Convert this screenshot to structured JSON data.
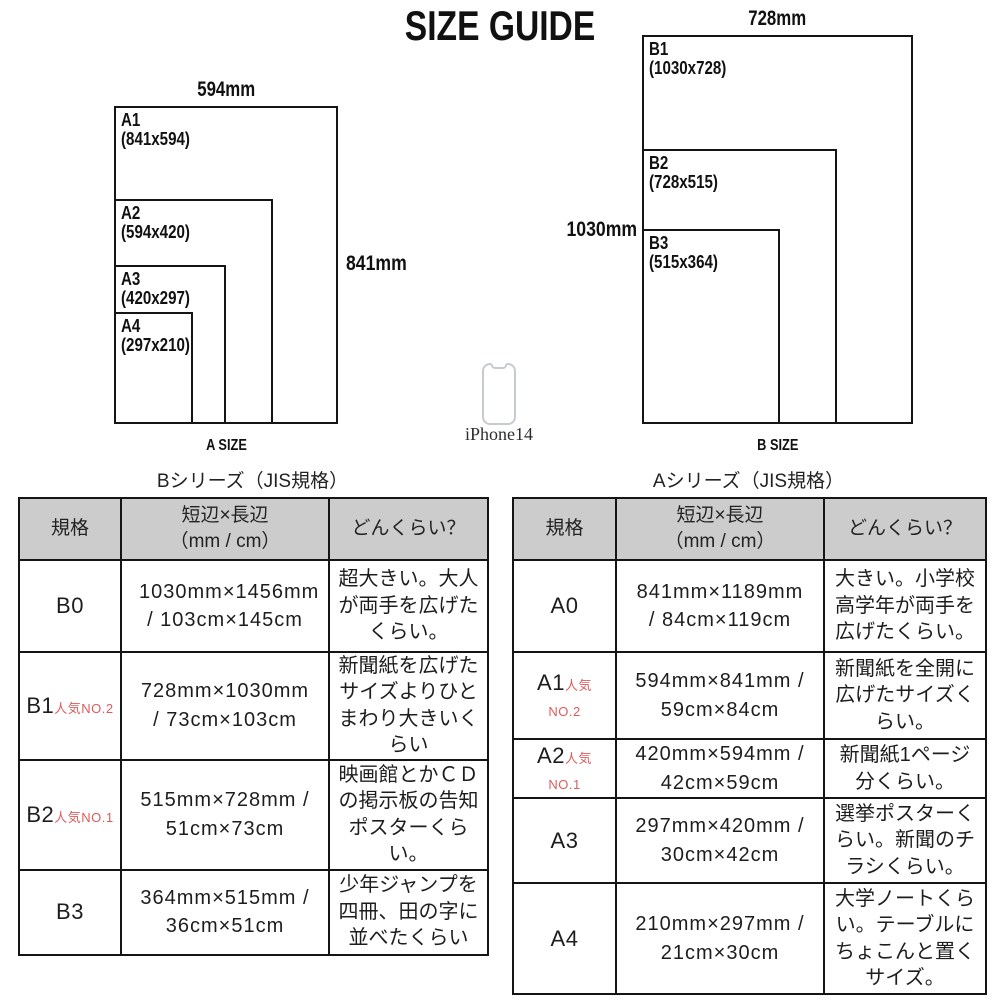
{
  "title": "SIZE GUIDE",
  "diagram_a": {
    "caption": "A SIZE",
    "width_label": "594mm",
    "height_label": "841mm",
    "sizes": [
      {
        "name": "A1",
        "dims": "(841x594)"
      },
      {
        "name": "A2",
        "dims": "(594x420)"
      },
      {
        "name": "A3",
        "dims": "(420x297)"
      },
      {
        "name": "A4",
        "dims": "(297x210)"
      }
    ]
  },
  "diagram_b": {
    "caption": "B SIZE",
    "width_label": "728mm",
    "height_label": "1030mm",
    "sizes": [
      {
        "name": "B1",
        "dims": "(1030x728)"
      },
      {
        "name": "B2",
        "dims": "(728x515)"
      },
      {
        "name": "B3",
        "dims": "(515x364)"
      }
    ]
  },
  "phone": {
    "label": "iPhone14"
  },
  "tables": [
    {
      "title": "Bシリーズ（JIS規格）",
      "headers": [
        "規格",
        "短辺×長辺\n（mm / cm）",
        "どんくらい？"
      ],
      "rows": [
        {
          "size": "B0",
          "badge": "",
          "dimensions": "1030mm×1456mm / 103cm×145cm",
          "description": "超大きい。大人が両手を広げたくらい。"
        },
        {
          "size": "B1",
          "badge": "人気NO.2",
          "dimensions": "728mm×1030mm / 73cm×103cm",
          "description": "新聞紙を広げたサイズよりひとまわり大きいくらい"
        },
        {
          "size": "B2",
          "badge": "人気NO.1",
          "dimensions": "515mm×728mm / 51cm×73cm",
          "description": "映画館とかＣＤの掲示板の告知ポスターくらい。"
        },
        {
          "size": "B3",
          "badge": "",
          "dimensions": "364mm×515mm / 36cm×51cm",
          "description": "少年ジャンプを四冊、田の字に並べたくらい"
        }
      ]
    },
    {
      "title": "Aシリーズ（JIS規格）",
      "headers": [
        "規格",
        "短辺×長辺\n（mm / cm）",
        "どんくらい？"
      ],
      "rows": [
        {
          "size": "A0",
          "badge": "",
          "dimensions": "841mm×1189mm / 84cm×119cm",
          "description": "大きい。小学校高学年が両手を広げたくらい。"
        },
        {
          "size": "A1",
          "badge": "人気NO.2",
          "dimensions": "594mm×841mm / 59cm×84cm",
          "description": "新聞紙を全開に広げたサイズくらい。"
        },
        {
          "size": "A2",
          "badge": "人気NO.1",
          "dimensions": "420mm×594mm / 42cm×59cm",
          "description": "新聞紙1ページ分くらい。"
        },
        {
          "size": "A3",
          "badge": "",
          "dimensions": "297mm×420mm / 30cm×42cm",
          "description": "選挙ポスターくらい。新聞のチラシくらい。"
        },
        {
          "size": "A4",
          "badge": "",
          "dimensions": "210mm×297mm / 21cm×30cm",
          "description": "大学ノートくらい。テーブルにちょこんと置くサイズ。"
        }
      ]
    }
  ],
  "colors": {
    "accent_red": "#dd5c5c",
    "header_gray": "#cccccc",
    "line_black": "#151515"
  }
}
